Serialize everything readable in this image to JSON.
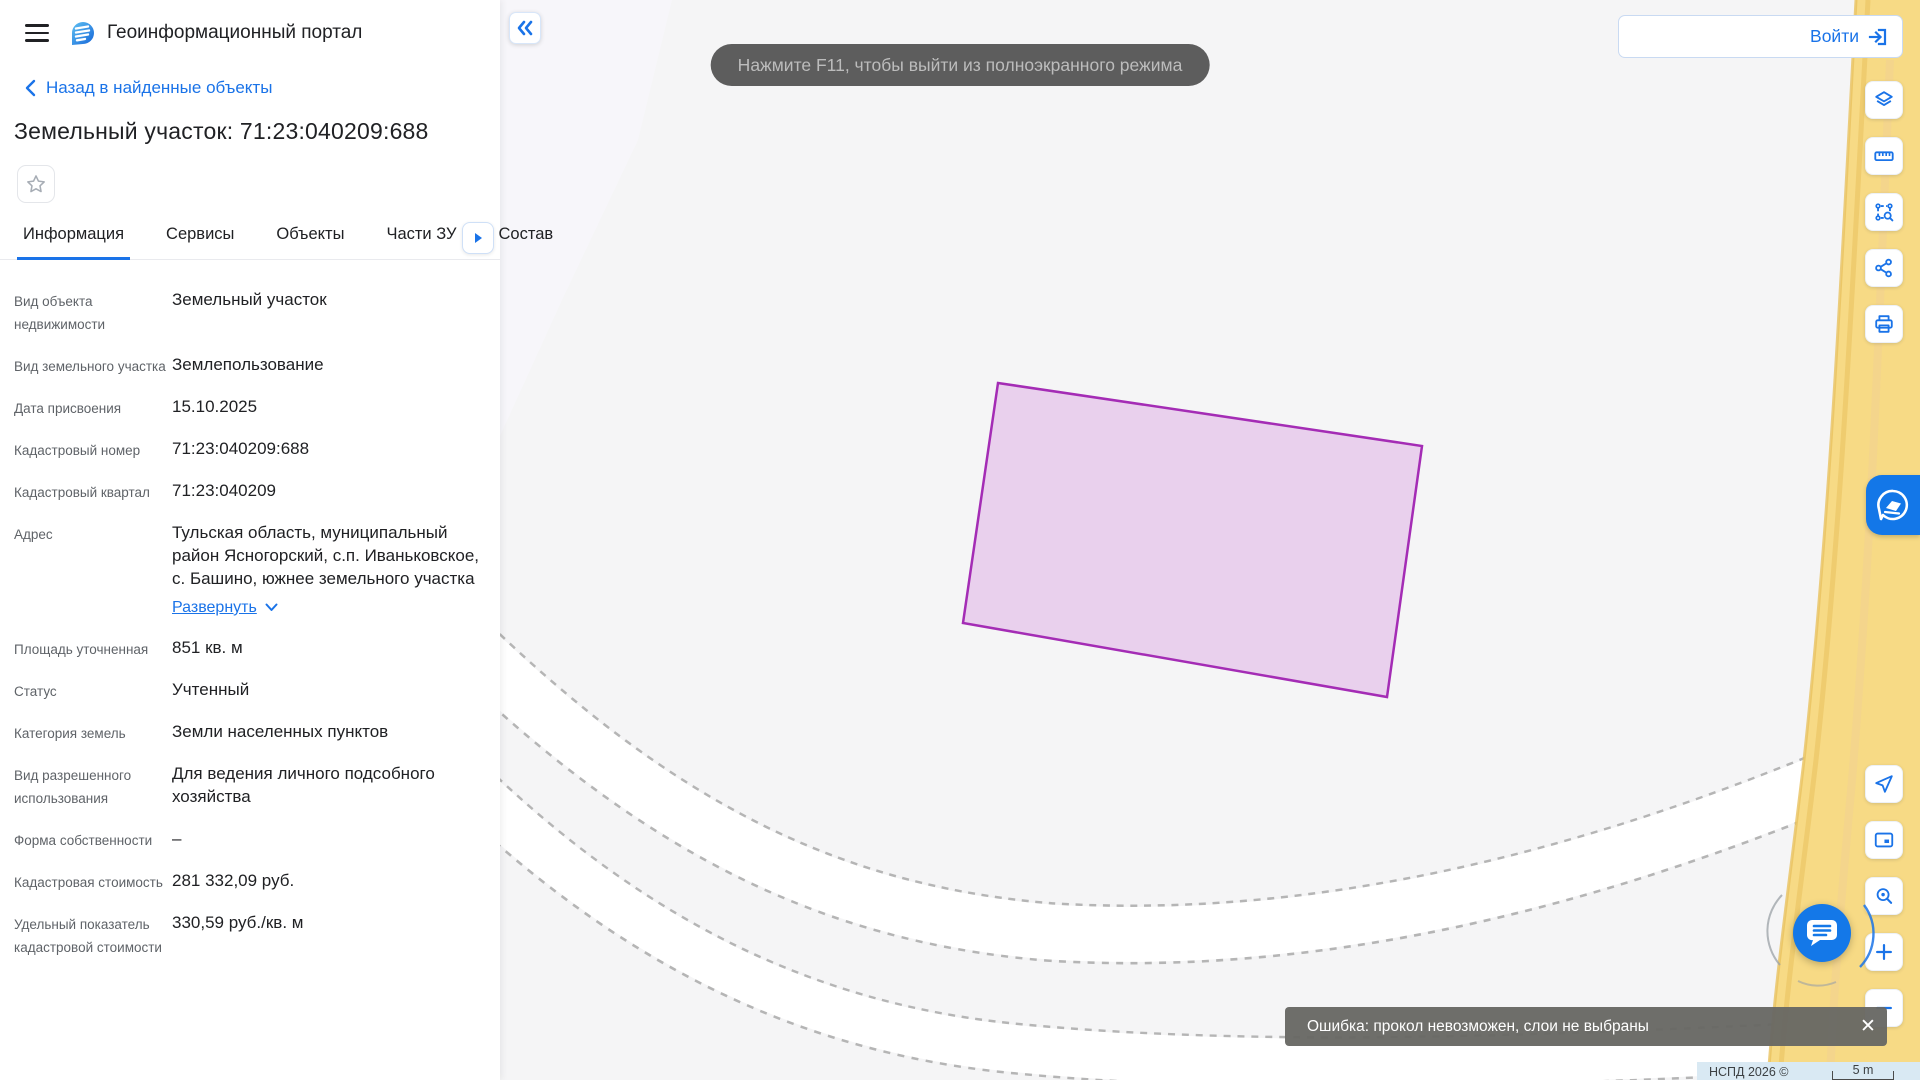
{
  "header": {
    "app_title": "Геоинформационный портал"
  },
  "panel": {
    "back_link": "Назад в найденные объекты",
    "title": "Земельный участок: 71:23:040209:688",
    "tabs": [
      {
        "label": "Информация",
        "active": true
      },
      {
        "label": "Сервисы",
        "active": false
      },
      {
        "label": "Объекты",
        "active": false
      },
      {
        "label": "Части ЗУ",
        "active": false
      },
      {
        "label": "Состав",
        "active": false
      }
    ],
    "expand_label": "Развернуть",
    "fields": [
      {
        "label": "Вид объекта недвижимости",
        "value": "Земельный участок"
      },
      {
        "label": "Вид земельного участка",
        "value": "Землепользование"
      },
      {
        "label": "Дата присвоения",
        "value": "15.10.2025"
      },
      {
        "label": "Кадастровый номер",
        "value": "71:23:040209:688"
      },
      {
        "label": "Кадастровый квартал",
        "value": "71:23:040209"
      },
      {
        "label": "Адрес",
        "value": "Тульская область, муниципальный район Ясногорский, с.п. Иваньковское, с. Башино, южнее земельного участка",
        "expandable": true
      },
      {
        "label": "Площадь уточненная",
        "value": "851 кв. м"
      },
      {
        "label": "Статус",
        "value": "Учтенный"
      },
      {
        "label": "Категория земель",
        "value": "Земли населенных пунктов"
      },
      {
        "label": "Вид разрешенного использования",
        "value": "Для ведения личного подсобного хозяйства"
      },
      {
        "label": "Форма собственности",
        "value": "–"
      },
      {
        "label": "Кадастровая стоимость",
        "value": "281 332,09 руб."
      },
      {
        "label": "Удельный показатель кадастровой стоимости",
        "value": "330,59 руб./кв. м"
      }
    ]
  },
  "toasts": {
    "fullscreen_hint": "Нажмите F11, чтобы выйти из полноэкранного режима",
    "error": "Ошибка: прокол невозможен, слои не выбраны"
  },
  "login": {
    "label": "Войти",
    "input_value": "",
    "input_placeholder": ""
  },
  "map": {
    "attribution": "НСПД 2026 ©",
    "scale_label": "5 m",
    "parcel_cadastral_number": "71:23:040209:688"
  },
  "colors": {
    "accent_blue": "#1a73e8",
    "parcel_stroke": "#a42cb5",
    "parcel_fill": "#ead4ee",
    "road_yellow": "#f7da85",
    "map_background": "#f5f5f6"
  },
  "toolbar_names": {
    "top": [
      "layers",
      "ruler",
      "select-area",
      "share",
      "print"
    ],
    "bottom": [
      "locate",
      "overview-map",
      "zoom-to-object",
      "zoom-in",
      "zoom-out"
    ]
  }
}
